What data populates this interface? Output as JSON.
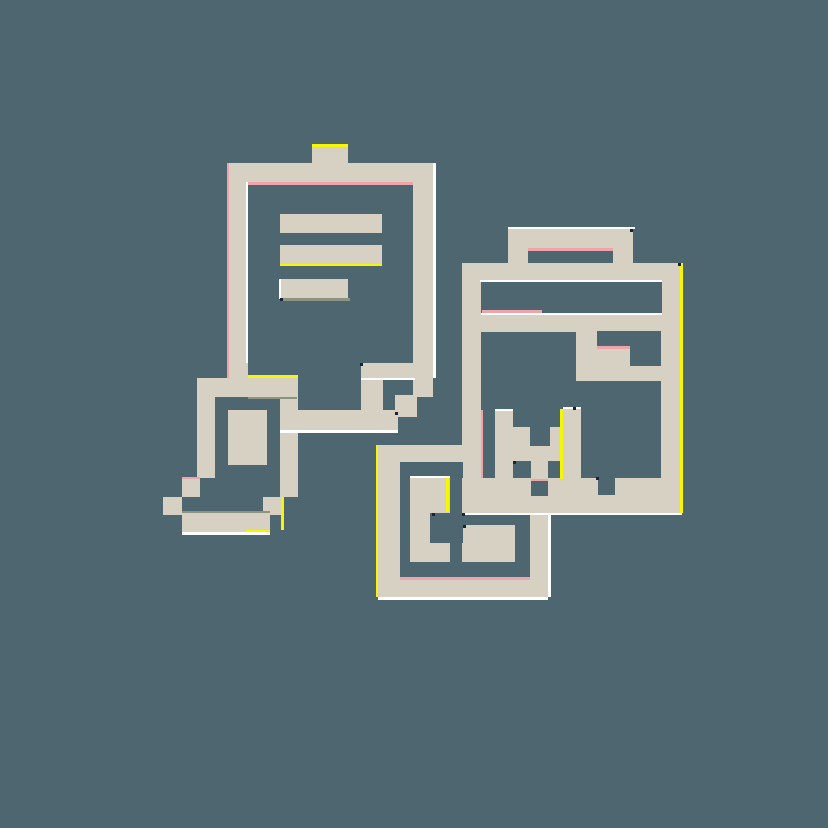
{
  "canvas": {
    "width": 828,
    "height": 828,
    "background": "#4d6670"
  },
  "icon": {
    "name": "pixel-clipboards-glitch-icon",
    "description": "Beige pixel-art icon of two clipboards, a small torn document and a spiral folder shape with glitch accent lines on a slate background",
    "palette": {
      "beige": "#d6d1c3",
      "slate": "#4d6670",
      "yellow": "#f6f600",
      "pink": "#efa3ab",
      "white": "#ffffff",
      "gray": "#8d9383",
      "navy": "#1c2236"
    },
    "layers": {
      "beige": [
        [
          229,
          163,
          204,
          215
        ],
        [
          229,
          378,
          19,
          19
        ],
        [
          413,
          378,
          20,
          19
        ],
        [
          312,
          147,
          36,
          51
        ],
        [
          361,
          363,
          72,
          15
        ],
        [
          361,
          363,
          22,
          67
        ],
        [
          395,
          395,
          22,
          22
        ],
        [
          280,
          410,
          118,
          20
        ],
        [
          197,
          378,
          100,
          19
        ],
        [
          197,
          378,
          18,
          100
        ],
        [
          280,
          378,
          18,
          119
        ],
        [
          182,
          478,
          18,
          19
        ],
        [
          163,
          497,
          19,
          18
        ],
        [
          182,
          513,
          88,
          19
        ],
        [
          263,
          497,
          20,
          18
        ],
        [
          508,
          229,
          125,
          19
        ],
        [
          508,
          229,
          20,
          34
        ],
        [
          613,
          229,
          20,
          34
        ],
        [
          462,
          263,
          220,
          250
        ],
        [
          378,
          445,
          170,
          152
        ]
      ],
      "holes": [
        [
          248,
          182,
          165,
          181
        ],
        [
          248,
          363,
          113,
          15
        ],
        [
          215,
          397,
          65,
          81
        ],
        [
          528,
          248,
          85,
          15
        ],
        [
          481,
          282,
          181,
          31
        ],
        [
          481,
          332,
          14,
          146
        ],
        [
          495,
          332,
          18,
          79
        ],
        [
          513,
          332,
          17,
          95
        ],
        [
          530,
          332,
          20,
          114
        ],
        [
          550,
          332,
          13,
          95
        ],
        [
          563,
          332,
          13,
          77
        ],
        [
          597,
          331,
          64,
          18
        ],
        [
          630,
          349,
          31,
          17
        ],
        [
          576,
          381,
          85,
          28
        ],
        [
          581,
          409,
          80,
          69
        ],
        [
          513,
          461,
          18,
          17
        ],
        [
          548,
          461,
          13,
          17
        ],
        [
          531,
          479,
          17,
          17
        ],
        [
          598,
          478,
          17,
          17
        ],
        [
          400,
          462,
          63,
          16
        ],
        [
          400,
          478,
          10,
          99
        ],
        [
          450,
          462,
          12,
          115
        ],
        [
          430,
          513,
          100,
          12
        ],
        [
          430,
          525,
          33,
          18
        ],
        [
          515,
          525,
          15,
          37
        ],
        [
          400,
          562,
          130,
          15
        ]
      ],
      "overlay_beige": [
        [
          228,
          410,
          39,
          55
        ],
        [
          280,
          214,
          102,
          19
        ],
        [
          280,
          245,
          102,
          20
        ],
        [
          280,
          279,
          68,
          20
        ]
      ],
      "accents": [
        {
          "color": "yellow",
          "rect": [
            312,
            144,
            36,
            3
          ]
        },
        {
          "color": "yellow",
          "rect": [
            280,
            264,
            102,
            2
          ]
        },
        {
          "color": "yellow",
          "rect": [
            248,
            375,
            50,
            3
          ]
        },
        {
          "color": "yellow",
          "rect": [
            246,
            530,
            24,
            2
          ]
        },
        {
          "color": "yellow",
          "rect": [
            281,
            497,
            3,
            33
          ]
        },
        {
          "color": "yellow",
          "rect": [
            680,
            263,
            3,
            250
          ]
        },
        {
          "color": "yellow",
          "rect": [
            560,
            409,
            3,
            70
          ]
        },
        {
          "color": "yellow",
          "rect": [
            446,
            478,
            3,
            34
          ]
        },
        {
          "color": "yellow",
          "rect": [
            376,
            445,
            2,
            152
          ]
        },
        {
          "color": "pink",
          "rect": [
            528,
            248,
            85,
            3
          ]
        },
        {
          "color": "pink",
          "rect": [
            248,
            182,
            165,
            3
          ]
        },
        {
          "color": "pink",
          "rect": [
            481,
            410,
            2,
            68
          ]
        },
        {
          "color": "pink",
          "rect": [
            597,
            346,
            33,
            3
          ]
        },
        {
          "color": "pink",
          "rect": [
            482,
            310,
            60,
            3
          ]
        },
        {
          "color": "pink",
          "rect": [
            531,
            479,
            17,
            2
          ]
        },
        {
          "color": "pink",
          "rect": [
            182,
            477,
            18,
            2
          ]
        },
        {
          "color": "pink",
          "rect": [
            400,
            577,
            130,
            3
          ]
        },
        {
          "color": "pink",
          "rect": [
            227,
            163,
            2,
            215
          ]
        },
        {
          "color": "white",
          "rect": [
            246,
            182,
            2,
            181
          ]
        },
        {
          "color": "white",
          "rect": [
            433,
            163,
            3,
            215
          ]
        },
        {
          "color": "white",
          "rect": [
            361,
            378,
            54,
            2
          ]
        },
        {
          "color": "white",
          "rect": [
            280,
            430,
            118,
            3
          ]
        },
        {
          "color": "white",
          "rect": [
            182,
            532,
            88,
            3
          ]
        },
        {
          "color": "white",
          "rect": [
            279,
            279,
            2,
            20
          ]
        },
        {
          "color": "white",
          "rect": [
            508,
            227,
            127,
            2
          ]
        },
        {
          "color": "white",
          "rect": [
            480,
            280,
            182,
            2
          ]
        },
        {
          "color": "white",
          "rect": [
            481,
            313,
            181,
            2
          ]
        },
        {
          "color": "white",
          "rect": [
            462,
            513,
            220,
            2
          ]
        },
        {
          "color": "white",
          "rect": [
            378,
            597,
            170,
            3
          ]
        },
        {
          "color": "white",
          "rect": [
            548,
            513,
            3,
            84
          ]
        },
        {
          "color": "white",
          "rect": [
            495,
            409,
            18,
            2
          ]
        },
        {
          "color": "white",
          "rect": [
            563,
            407,
            18,
            2
          ]
        },
        {
          "color": "white",
          "rect": [
            410,
            476,
            40,
            2
          ]
        },
        {
          "color": "gray",
          "rect": [
            283,
            298,
            67,
            3
          ]
        },
        {
          "color": "gray",
          "rect": [
            248,
            397,
            49,
            2
          ]
        },
        {
          "color": "gray",
          "rect": [
            182,
            511,
            88,
            2
          ]
        }
      ],
      "dots": [
        [
          678,
          263
        ],
        [
          630,
          229
        ],
        [
          462,
          513
        ],
        [
          513,
          461
        ],
        [
          463,
          525
        ],
        [
          432,
          513
        ],
        [
          596,
          477
        ],
        [
          360,
          363
        ],
        [
          280,
          298
        ],
        [
          395,
          412
        ],
        [
          573,
          407
        ]
      ]
    }
  }
}
